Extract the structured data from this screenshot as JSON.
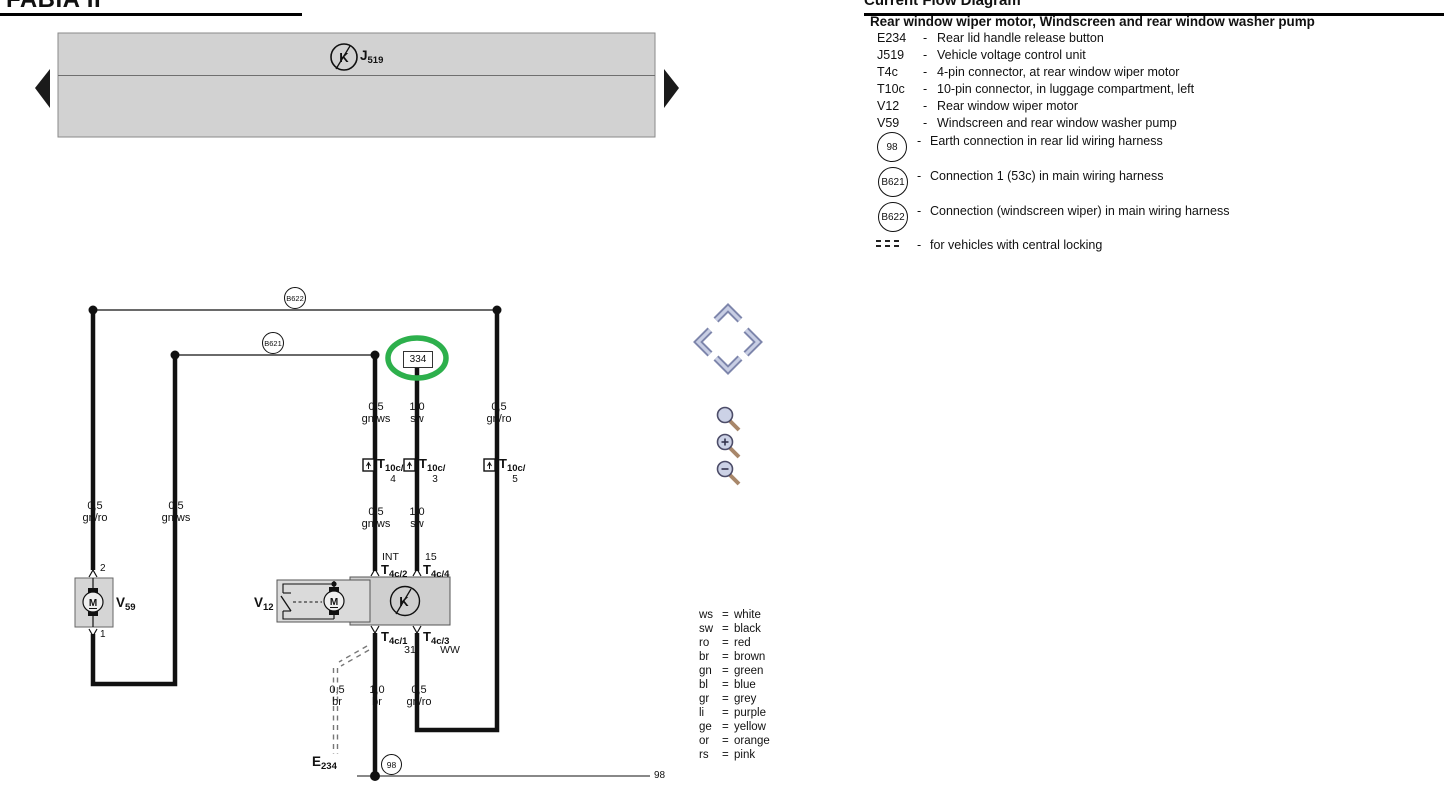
{
  "header": {
    "left_title": "FABIA II",
    "right_title": "Current Flow Diagram"
  },
  "legend": {
    "title": "Rear window wiper motor, Windscreen and rear window washer pump",
    "sep": "-",
    "items": [
      {
        "code": "E234",
        "desc": "Rear lid handle release button"
      },
      {
        "code": "J519",
        "desc": "Vehicle voltage control unit"
      },
      {
        "code": "T4c",
        "desc": "4-pin connector, at rear window wiper motor"
      },
      {
        "code": "T10c",
        "desc": "10-pin connector, in luggage compartment, left"
      },
      {
        "code": "V12",
        "desc": "Rear window wiper motor"
      },
      {
        "code": "V59",
        "desc": "Windscreen and rear window washer pump"
      }
    ],
    "circle_items": [
      {
        "code": "98",
        "desc": "Earth connection in rear lid wiring harness"
      },
      {
        "code": "B621",
        "desc": "Connection 1 (53c) in main wiring harness"
      },
      {
        "code": "B622",
        "desc": "Connection (windscreen wiper) in main wiring harness"
      }
    ],
    "dashed_item_desc": "for vehicles with central locking"
  },
  "color_sep": "=",
  "color_codes": [
    {
      "abbr": "ws",
      "name": "white"
    },
    {
      "abbr": "sw",
      "name": "black"
    },
    {
      "abbr": "ro",
      "name": "red"
    },
    {
      "abbr": "br",
      "name": "brown"
    },
    {
      "abbr": "gn",
      "name": "green"
    },
    {
      "abbr": "bl",
      "name": "blue"
    },
    {
      "abbr": "gr",
      "name": "grey"
    },
    {
      "abbr": "li",
      "name": "purple"
    },
    {
      "abbr": "ge",
      "name": "yellow"
    },
    {
      "abbr": "or",
      "name": "orange"
    },
    {
      "abbr": "rs",
      "name": "pink"
    }
  ],
  "diagram": {
    "j519": {
      "main": "J",
      "sub": "519",
      "symbol": "K"
    },
    "v12": {
      "main": "V",
      "sub": "12",
      "motor": "M",
      "symbol": "K"
    },
    "v59": {
      "main": "V",
      "sub": "59",
      "motor": "M",
      "pin_top": "2",
      "pin_bottom": "1"
    },
    "e234": {
      "main": "E",
      "sub": "234"
    },
    "b622": "B622",
    "b621": "B621",
    "earth_circle": "98",
    "earth_line_label": "98",
    "track_number": "334",
    "highlight_color": "#2db04c",
    "connectors": {
      "t10c4": {
        "main": "T",
        "sub": "10c/",
        "pin": "4"
      },
      "t10c3": {
        "main": "T",
        "sub": "10c/",
        "pin": "3"
      },
      "t10c5": {
        "main": "T",
        "sub": "10c/",
        "pin": "5"
      },
      "t4c2": {
        "designation": "INT",
        "main": "T",
        "sub": "4c/2"
      },
      "t4c4": {
        "designation": "15",
        "main": "T",
        "sub": "4c/4"
      },
      "t4c1": {
        "main": "T",
        "sub": "4c/1",
        "designation": "31"
      },
      "t4c3": {
        "main": "T",
        "sub": "4c/3",
        "designation": "WW"
      }
    },
    "wires": {
      "top_gnws": {
        "size": "0,5",
        "color": "gn/ws"
      },
      "top_sw": {
        "size": "1,0",
        "color": "sw"
      },
      "top_gnro": {
        "size": "0,5",
        "color": "gn/ro"
      },
      "left_gnro": {
        "size": "0,5",
        "color": "gn/ro"
      },
      "left_gnws": {
        "size": "0,5",
        "color": "gn/ws"
      },
      "mid_gnws": {
        "size": "0,5",
        "color": "gn/ws"
      },
      "mid_sw": {
        "size": "1,0",
        "color": "sw"
      },
      "bot_br05": {
        "size": "0,5",
        "color": "br"
      },
      "bot_br10": {
        "size": "1,0",
        "color": "br"
      },
      "bot_gnro": {
        "size": "0,5",
        "color": "gn/ro"
      }
    }
  }
}
